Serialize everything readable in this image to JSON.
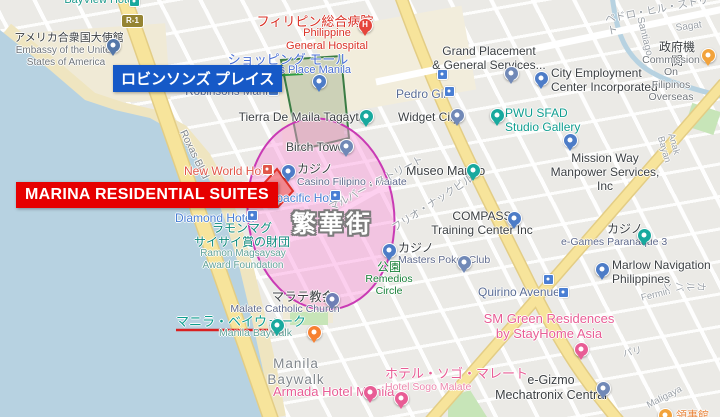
{
  "annotations": {
    "robinsons_place_callout": "ロビンソンズ プレイス",
    "marina_callout": "MARINA RESIDENTIAL SUITES",
    "district_label": "繁華街",
    "underlined_place": "マニラ・ベイウォーク",
    "colors": {
      "callout_red": "#e60000",
      "callout_blue": "#1659c7",
      "district_zone_pink": "#c93ab4",
      "robinsons_zone_green": "#3a7d44",
      "marina_zone_red": "#e03028",
      "underline_red": "#d92020"
    }
  },
  "route_badge": "R-1",
  "labels": [
    {
      "id": "bayview-hotel",
      "t": "BayView Hotel",
      "x": 100,
      "y": -6,
      "c": "#1d9a8c",
      "s": 11,
      "a": "c",
      "inter": true
    },
    {
      "id": "us-embassy-jp",
      "t": "アメリカ合衆国大使館",
      "x": 69,
      "y": 32,
      "c": "#3c4043",
      "s": 11,
      "a": "c",
      "inter": true
    },
    {
      "id": "us-embassy-en",
      "t": "Embassy of the United\nStates of America",
      "x": 66,
      "y": 45,
      "c": "#70757a",
      "s": 10,
      "a": "c",
      "inter": true
    },
    {
      "id": "phil-general-hospital-jp",
      "t": "フィリピン総合病院",
      "x": 315,
      "y": 14,
      "c": "#d93025",
      "s": 13,
      "a": "c",
      "inter": true
    },
    {
      "id": "phil-general-hospital-en",
      "t": "Philippine\nGeneral Hospital",
      "x": 327,
      "y": 27,
      "c": "#d93025",
      "s": 11,
      "a": "c",
      "inter": true
    },
    {
      "id": "shopping-mall-jp",
      "t": "ショッピング モール",
      "x": 288,
      "y": 52,
      "c": "#4a6fd4",
      "s": 13,
      "a": "c",
      "inter": true
    },
    {
      "id": "robinsons-place-manila",
      "t": "Robinsons Place Manila",
      "x": 292,
      "y": 64,
      "c": "#4a6fd4",
      "s": 11,
      "a": "c",
      "inter": true
    },
    {
      "id": "robinsons-manila-station",
      "t": "Robinsons Manila",
      "x": 231,
      "y": 86,
      "c": "#5a6d96",
      "s": 11.5,
      "a": "c",
      "inter": true
    },
    {
      "id": "tierra-de-maila",
      "t": "Tierra De Maila Tagaytay",
      "x": 305,
      "y": 110,
      "c": "#3c4043",
      "s": 12,
      "a": "c",
      "inter": true
    },
    {
      "id": "pedro-gil-station",
      "t": "Pedro Gil",
      "x": 396,
      "y": 87,
      "c": "#5a6d96",
      "s": 12,
      "a": "l",
      "inter": true
    },
    {
      "id": "widget-city",
      "t": "Widget City",
      "x": 398,
      "y": 110,
      "c": "#3c4043",
      "s": 12,
      "a": "l",
      "inter": true
    },
    {
      "id": "grand-placement",
      "t": "Grand Placement\n& General Services...",
      "x": 489,
      "y": 44,
      "c": "#3c4043",
      "s": 12,
      "a": "c",
      "inter": true
    },
    {
      "id": "city-employment",
      "t": "City Employment\nCenter Incorporated",
      "x": 551,
      "y": 66,
      "c": "#3c4043",
      "s": 12,
      "a": "l",
      "inter": true
    },
    {
      "id": "gov-agency-jp",
      "t": "政府機関",
      "x": 677,
      "y": 40,
      "c": "#3c4043",
      "s": 12,
      "a": "c",
      "inter": true
    },
    {
      "id": "commission-filipinos",
      "t": "Commission On\nFilipinos Overseas",
      "x": 671,
      "y": 54,
      "c": "#70757a",
      "s": 10.5,
      "a": "c",
      "inter": true
    },
    {
      "id": "pedro-gil-street",
      "t": "ペドロ・ヒル・ストリート",
      "x": 604,
      "y": 14,
      "c": "#9aa0a6",
      "s": 10.5,
      "a": "l",
      "r": -11,
      "inter": false
    },
    {
      "id": "santiago-street",
      "t": "Santiago",
      "x": 645,
      "y": 16,
      "c": "#9aa0a6",
      "s": 10,
      "a": "l",
      "r": 76,
      "inter": false
    },
    {
      "id": "sagat-street",
      "t": "Sagat",
      "x": 675,
      "y": 23,
      "c": "#9aa0a6",
      "s": 10,
      "a": "l",
      "r": -8,
      "inter": false
    },
    {
      "id": "pwu-sfad",
      "t": "PWU SFAD\nStudio Gallery",
      "x": 505,
      "y": 106,
      "c": "#0f9d8f",
      "s": 12,
      "a": "l",
      "inter": true
    },
    {
      "id": "mission-way",
      "t": "Mission Way\nManpower Services, Inc",
      "x": 605,
      "y": 151,
      "c": "#3c4043",
      "s": 12,
      "a": "c",
      "inter": true
    },
    {
      "id": "museo-marino",
      "t": "Museo Marino",
      "x": 406,
      "y": 164,
      "c": "#3c4043",
      "s": 12.5,
      "a": "l",
      "inter": true
    },
    {
      "id": "compass-training",
      "t": "COMPASS\nTraining Center Inc",
      "x": 482,
      "y": 209,
      "c": "#3c4043",
      "s": 12,
      "a": "c",
      "inter": true
    },
    {
      "id": "roxas-blvd",
      "t": "Roxas Blvd",
      "x": 188,
      "y": 128,
      "c": "#80868b",
      "s": 10.5,
      "a": "l",
      "r": 64,
      "inter": false
    },
    {
      "id": "new-world-hotel",
      "t": "New World Hotel",
      "x": 184,
      "y": 164,
      "c": "#e15649",
      "s": 12,
      "a": "l",
      "inter": true
    },
    {
      "id": "casino-filipino-jp",
      "t": "カジノ",
      "x": 297,
      "y": 162,
      "c": "#3c4043",
      "s": 12,
      "a": "l",
      "inter": true
    },
    {
      "id": "casino-filipino-en",
      "t": "Casino Filipino · Malate",
      "x": 297,
      "y": 176,
      "c": "#5f6a8c",
      "s": 10.5,
      "a": "l",
      "inter": true
    },
    {
      "id": "birch-tower",
      "t": "Birch Tower",
      "x": 286,
      "y": 140,
      "c": "#3c4043",
      "s": 12,
      "a": "l",
      "inter": true
    },
    {
      "id": "panpacific-hotel",
      "t": "Panpacific Hotel",
      "x": 255,
      "y": 191,
      "c": "#4a7fd4",
      "s": 12,
      "a": "l",
      "inter": true
    },
    {
      "id": "diamond-hotel",
      "t": "Diamond Hotel",
      "x": 175,
      "y": 211,
      "c": "#4a7fd4",
      "s": 12,
      "a": "l",
      "inter": true
    },
    {
      "id": "malvar-street",
      "t": "マルバー・ストリート",
      "x": 327,
      "y": 203,
      "c": "#9aa0a6",
      "s": 10.5,
      "a": "l",
      "r": -28,
      "inter": false
    },
    {
      "id": "julio-nakpil-street",
      "t": "フリオ・ナックビル",
      "x": 390,
      "y": 224,
      "c": "#9aa0a6",
      "s": 10.5,
      "a": "l",
      "r": -33,
      "inter": false
    },
    {
      "id": "ramon-magsaysay-jp",
      "t": "ラモンマグ\nサイサイ賞の財団",
      "x": 242,
      "y": 221,
      "c": "#0f8a7d",
      "s": 12,
      "a": "c",
      "inter": true
    },
    {
      "id": "ramon-magsaysay-en",
      "t": "Ramon Magsaysay\nAward Foundation",
      "x": 243,
      "y": 248,
      "c": "#63a39a",
      "s": 10,
      "a": "c",
      "inter": true
    },
    {
      "id": "masters-poker-jp",
      "t": "カジノ",
      "x": 398,
      "y": 241,
      "c": "#3c4043",
      "s": 12,
      "a": "l",
      "inter": true
    },
    {
      "id": "masters-poker-en",
      "t": "Masters Poker Club",
      "x": 398,
      "y": 254,
      "c": "#5f6a8c",
      "s": 10.5,
      "a": "l",
      "inter": true
    },
    {
      "id": "park-jp",
      "t": "公園",
      "x": 389,
      "y": 260,
      "c": "#188038",
      "s": 12,
      "a": "c",
      "inter": true
    },
    {
      "id": "remedios-circle",
      "t": "Remedios\nCircle",
      "x": 389,
      "y": 273,
      "c": "#188038",
      "s": 10.5,
      "a": "c",
      "inter": true
    },
    {
      "id": "malate-church-jp",
      "t": "マラテ教会",
      "x": 303,
      "y": 290,
      "c": "#3c4043",
      "s": 12.5,
      "a": "c",
      "inter": true
    },
    {
      "id": "malate-church-en",
      "t": "Malate Catholic Church",
      "x": 285,
      "y": 303,
      "c": "#5f6a8c",
      "s": 10.5,
      "a": "c",
      "inter": true
    },
    {
      "id": "quirino-avenue",
      "t": "Quirino Avenue",
      "x": 478,
      "y": 285,
      "c": "#5a6d96",
      "s": 12,
      "a": "l",
      "inter": true
    },
    {
      "id": "marlow-navigation",
      "t": "Marlow Navigation\nPhilippines",
      "x": 612,
      "y": 258,
      "c": "#3c4043",
      "s": 12,
      "a": "l",
      "inter": true
    },
    {
      "id": "egames-jp",
      "t": "カジノ",
      "x": 607,
      "y": 222,
      "c": "#3c4043",
      "s": 12,
      "a": "l",
      "inter": true
    },
    {
      "id": "egames-en",
      "t": "e-Games Paranaque 3",
      "x": 561,
      "y": 236,
      "c": "#5f6a8c",
      "s": 10.5,
      "a": "l",
      "inter": true
    },
    {
      "id": "sm-green-residences",
      "t": "SM Green Residences\nby StayHome Asia",
      "x": 549,
      "y": 311,
      "c": "#e85d95",
      "s": 13,
      "a": "c",
      "inter": true
    },
    {
      "id": "egizmo-mechatronix",
      "t": "e-Gizmo\nMechatronix Central",
      "x": 551,
      "y": 373,
      "c": "#3c4043",
      "s": 12.5,
      "a": "c",
      "inter": true
    },
    {
      "id": "manila-baywalk-jp",
      "t": "マニラ・ベイウォーク",
      "x": 176,
      "y": 314,
      "c": "#0f9d8f",
      "s": 13,
      "a": "l",
      "inter": true
    },
    {
      "id": "manila-baywalk-en",
      "t": "Manila Baywalk",
      "x": 219,
      "y": 327,
      "c": "#63a39a",
      "s": 10.5,
      "a": "l",
      "inter": true
    },
    {
      "id": "manila-baywalk-area",
      "t": "Manila\nBaywalk",
      "x": 296,
      "y": 356,
      "c": "#80868b",
      "s": 13.5,
      "a": "c",
      "ls": 1,
      "inter": false
    },
    {
      "id": "armada-hotel",
      "t": "Armada Hotel Manila",
      "x": 273,
      "y": 384,
      "c": "#e85d95",
      "s": 13,
      "a": "l",
      "inter": true
    },
    {
      "id": "hotel-sogo-jp",
      "t": "ホテル・ソゴ・マレート",
      "x": 385,
      "y": 366,
      "c": "#e85d95",
      "s": 13,
      "a": "l",
      "inter": true
    },
    {
      "id": "hotel-sogo-en",
      "t": "Hotel Sogo Malate",
      "x": 385,
      "y": 381,
      "c": "#ec87ad",
      "s": 10.5,
      "a": "l",
      "inter": true
    },
    {
      "id": "fermin-street",
      "t": "Fermin",
      "x": 640,
      "y": 293,
      "c": "#9aa0a6",
      "s": 9.5,
      "a": "l",
      "r": -14,
      "inter": false
    },
    {
      "id": "pari-street",
      "t": "パリ",
      "x": 622,
      "y": 349,
      "c": "#9aa0a6",
      "s": 9.5,
      "a": "l",
      "r": -12,
      "inter": false
    },
    {
      "id": "maligaya-street",
      "t": "Maligaya",
      "x": 645,
      "y": 401,
      "c": "#9aa0a6",
      "s": 9.5,
      "a": "l",
      "r": -27,
      "inter": false
    },
    {
      "id": "anak-bayan-street",
      "t": "Anak Bayan",
      "x": 676,
      "y": 132,
      "c": "#9aa0a6",
      "s": 9.5,
      "a": "l",
      "r": 74,
      "inter": false
    },
    {
      "id": "karuban-street",
      "t": "カルバン",
      "x": 706,
      "y": 282,
      "c": "#9aa0a6",
      "s": 9.5,
      "a": "l",
      "r": 90,
      "inter": false
    },
    {
      "id": "consulate-partial",
      "t": "領事館",
      "x": 676,
      "y": 410,
      "c": "#e8853c",
      "s": 11,
      "a": "l",
      "inter": true
    }
  ],
  "markers": [
    {
      "id": "us-embassy",
      "x": 112,
      "y": 44,
      "c": "#5477a8",
      "k": "pin"
    },
    {
      "id": "hospital",
      "x": 364,
      "y": 24,
      "c": "#e5453c",
      "k": "pin",
      "g": "H"
    },
    {
      "id": "robinsons-shopping",
      "x": 318,
      "y": 80,
      "c": "#4d7cc7",
      "k": "pin"
    },
    {
      "id": "pedro-gil-station",
      "x": 441,
      "y": 73,
      "c": "#4a7fd4",
      "k": "sq"
    },
    {
      "id": "pedro-gil-inline",
      "x": 448,
      "y": 90,
      "c": "#4a7fd4",
      "k": "sq"
    },
    {
      "id": "tierra",
      "x": 365,
      "y": 115,
      "c": "#18a99e",
      "k": "pin"
    },
    {
      "id": "widget-city",
      "x": 456,
      "y": 114,
      "c": "#7189b7",
      "k": "pin"
    },
    {
      "id": "grand-placement",
      "x": 510,
      "y": 72,
      "c": "#7189b7",
      "k": "pin"
    },
    {
      "id": "city-employment",
      "x": 540,
      "y": 77,
      "c": "#4d7cc7",
      "k": "pin"
    },
    {
      "id": "commission",
      "x": 707,
      "y": 54,
      "c": "#f2a33c",
      "k": "pin"
    },
    {
      "id": "pwu-sfad",
      "x": 496,
      "y": 114,
      "c": "#18a99e",
      "k": "pin"
    },
    {
      "id": "mission-way",
      "x": 569,
      "y": 139,
      "c": "#4d7cc7",
      "k": "pin"
    },
    {
      "id": "museo-marino",
      "x": 472,
      "y": 169,
      "c": "#18a99e",
      "k": "pin"
    },
    {
      "id": "compass",
      "x": 513,
      "y": 217,
      "c": "#4d7cc7",
      "k": "pin"
    },
    {
      "id": "birch-tower",
      "x": 345,
      "y": 145,
      "c": "#7189b7",
      "k": "pin"
    },
    {
      "id": "casino-filipino",
      "x": 287,
      "y": 170,
      "c": "#4d7cc7",
      "k": "pin"
    },
    {
      "id": "masters-poker",
      "x": 388,
      "y": 249,
      "c": "#4d7cc7",
      "k": "pin"
    },
    {
      "id": "masters-poker-2",
      "x": 463,
      "y": 261,
      "c": "#7189b7",
      "k": "pin"
    },
    {
      "id": "egames",
      "x": 643,
      "y": 234,
      "c": "#18a99e",
      "k": "pin"
    },
    {
      "id": "marlow",
      "x": 601,
      "y": 268,
      "c": "#4d7cc7",
      "k": "pin"
    },
    {
      "id": "sm-green",
      "x": 580,
      "y": 348,
      "c": "#e85d95",
      "k": "pin"
    },
    {
      "id": "egizmo",
      "x": 602,
      "y": 387,
      "c": "#7189b7",
      "k": "pin"
    },
    {
      "id": "malate-church",
      "x": 331,
      "y": 298,
      "c": "#6f7fb5",
      "k": "pin"
    },
    {
      "id": "restaurant",
      "x": 313,
      "y": 331,
      "c": "#f78131",
      "k": "pin"
    },
    {
      "id": "baywalk-attraction",
      "x": 276,
      "y": 324,
      "c": "#18a99e",
      "k": "pin"
    },
    {
      "id": "armada-hotel",
      "x": 369,
      "y": 391,
      "c": "#e85d95",
      "k": "pin"
    },
    {
      "id": "hotel-sogo",
      "x": 400,
      "y": 397,
      "c": "#e85d95",
      "k": "pin"
    },
    {
      "id": "quirino-station",
      "x": 547,
      "y": 278,
      "c": "#4a7fd4",
      "k": "sq"
    },
    {
      "id": "quirino-inline",
      "x": 562,
      "y": 291,
      "c": "#4a7fd4",
      "k": "sq"
    },
    {
      "id": "consulate",
      "x": 664,
      "y": 414,
      "c": "#f2a33c",
      "k": "pin"
    },
    {
      "id": "new-world-inline",
      "x": 266,
      "y": 168,
      "c": "#e15649",
      "k": "sq"
    },
    {
      "id": "diamond-inline",
      "x": 251,
      "y": 214,
      "c": "#4a7fd4",
      "k": "sq"
    },
    {
      "id": "panpacific-inline",
      "x": 334,
      "y": 194,
      "c": "#4a7fd4",
      "k": "sq"
    },
    {
      "id": "robinsons-manila-inline",
      "x": 272,
      "y": 89,
      "c": "#4a7fd4",
      "k": "sq"
    },
    {
      "id": "bayview-inline",
      "x": 133,
      "y": 0,
      "c": "#18a99e",
      "k": "sq"
    }
  ]
}
